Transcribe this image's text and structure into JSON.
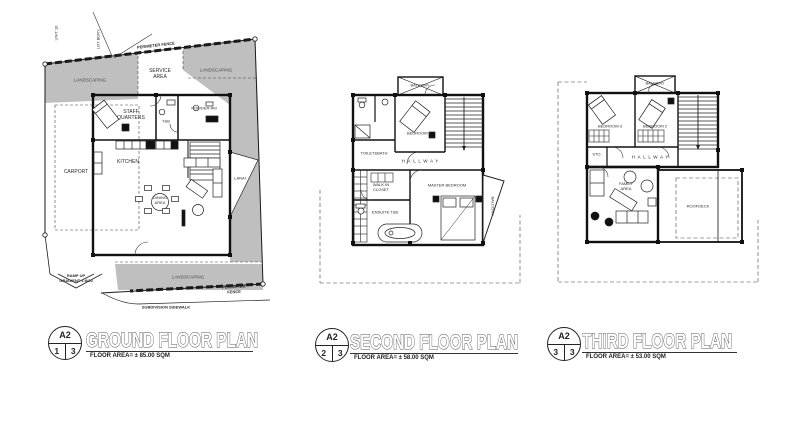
{
  "ground": {
    "labels": {
      "unit": "UNIT 10",
      "lot": "LOT BDRY.",
      "fence_top": "PERIMETER FENCE",
      "fence_bottom": "PERIMETER FENCE",
      "landscaping_top_left": "LANDSCAPING",
      "service_area": "SERVICE\nAREA",
      "landscaping_top_right": "LANDSCAPING",
      "carport": "CARPORT",
      "staff_quarters": "STAFF\nQUARTERS",
      "tb": "T&B",
      "powder": "POWDER RM",
      "kitchen": "KITCHEN",
      "dining": "DINING\nAREA",
      "lanai": "LANAI",
      "landscaping_bottom": "LANDSCAPING",
      "ramp": "RAMP UP\nGRADIENT 1:8/20",
      "sidewalk": "SUBDIVISION SIDEWALK"
    },
    "title": {
      "sheet": "A2",
      "num": "1",
      "total": "3",
      "name": "GROUND FLOOR PLAN",
      "area": "FLOOR AREA=  ± 85.00 SQM"
    }
  },
  "second": {
    "labels": {
      "balcony_top": "BALCONY",
      "toilet_bath": "TOILET&BATH",
      "bedroom1": "BEDROOM 1",
      "hallway": "HALLWAY",
      "wic": "WALK IN\nCLOSET",
      "ensuite": "ENSUITE T&B",
      "master": "MASTER BEDROOM",
      "balcony_right": "BALCONY"
    },
    "title": {
      "sheet": "A2",
      "num": "2",
      "total": "3",
      "name": "SECOND FLOOR PLAN",
      "area": "FLOOR AREA=  ± 58.00 SQM"
    }
  },
  "third": {
    "labels": {
      "balcony_top": "BALCONY",
      "bedroom3": "BEDROOM 3",
      "bedroom2": "BEDROOM 2",
      "hallway": "HALLWAY",
      "sto": "STO.",
      "family": "FAMILY\nAREA",
      "roofdeck": "ROOFDECK"
    },
    "title": {
      "sheet": "A2",
      "num": "3",
      "total": "3",
      "name": "THIRD FLOOR PLAN",
      "area": "FLOOR AREA=  ± 53.00 SQM"
    }
  }
}
